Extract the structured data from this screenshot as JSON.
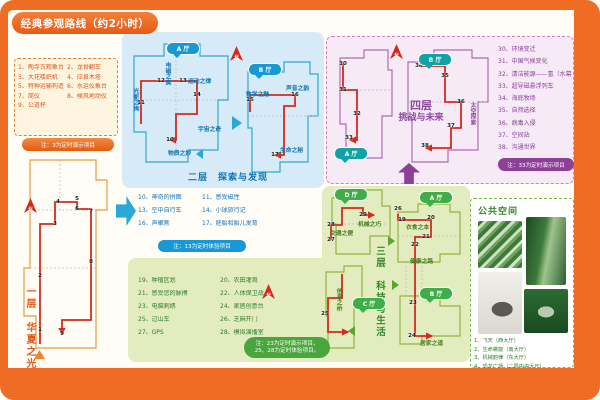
{
  "title": "经典参观路线（约2小时）",
  "compass_label": "北",
  "floor1": {
    "title": "一层　华夏之光",
    "items": [
      [
        "1、",
        "陶寺古观象台"
      ],
      [
        "2、",
        "龙骨翻车"
      ],
      [
        "3、",
        "大花楼织机"
      ],
      [
        "4、",
        "应县木塔"
      ],
      [
        "5、",
        "特种运输构造"
      ],
      [
        "6、",
        "水运仪象台"
      ],
      [
        "7、",
        "简仪"
      ],
      [
        "8、",
        "候风地动仪"
      ],
      [
        "9、",
        "公道杯"
      ]
    ],
    "note": "注：3为定时演示项目"
  },
  "floor2": {
    "title": "二层　探索与发现",
    "items": [
      [
        "10、",
        "神奇的拼图"
      ],
      [
        "11、",
        "感受磁性"
      ],
      [
        "13、",
        "空中自行车"
      ],
      [
        "14、",
        "小球旅行记"
      ],
      [
        "16、",
        "声聚焦"
      ],
      [
        "17、",
        "胚胎和胎儿发育"
      ]
    ],
    "note": "注：13为定时体验项目"
  },
  "floor3": {
    "title": "三层　科技与生活",
    "items": [
      [
        "19、",
        "种植区划"
      ],
      [
        "20、",
        "农田灌溉"
      ],
      [
        "21、",
        "感受您的脉搏"
      ],
      [
        "22、",
        "人体保卫战"
      ],
      [
        "23、",
        "电脑刺绣"
      ],
      [
        "24、",
        "家居创意台"
      ],
      [
        "25、",
        "过山车"
      ],
      [
        "26、",
        "芝麻开门"
      ],
      [
        "27、",
        "GPS"
      ],
      [
        "28、",
        "模拟演播室"
      ]
    ],
    "note": "注：23为定时演示项目，\n25、28为定时体验项目。"
  },
  "floor4": {
    "title_line1": "四层",
    "title_line2": "挑战与未来",
    "items": [
      [
        "30、",
        "环境变迁"
      ],
      [
        "31、",
        "中国气候变化"
      ],
      [
        "32、",
        "清洁能源——氢（水幕）"
      ],
      [
        "33、",
        "超导磁悬浮列车"
      ],
      [
        "34、",
        "海底牧场"
      ],
      [
        "35、",
        "自然选择"
      ],
      [
        "36、",
        "病毒入侵"
      ],
      [
        "37、",
        "空间站"
      ],
      [
        "38、",
        "沟通世界"
      ]
    ],
    "note": "注：33为定时演示项目"
  },
  "public_space": {
    "title": "公共空间",
    "captions": [
      "1、飞天（西大厅）",
      "2、生命螺旋（南大厅）",
      "3、机械韵律（东大厅）",
      "4、恐龙广场（二层中央大厅）"
    ],
    "photos": [
      "ceiling-art",
      "spiral-staircase",
      "dinosaur-skeleton",
      "relief-mural"
    ]
  },
  "hall_labels": [
    {
      "t": "光影之绚",
      "x": 131,
      "y": 88,
      "v": 1,
      "c": "f2"
    },
    {
      "t": "电磁之奥",
      "x": 163,
      "y": 62,
      "v": 1,
      "c": "f2"
    },
    {
      "t": "运动之律",
      "x": 188,
      "y": 76,
      "v": 0,
      "c": "f2"
    },
    {
      "t": "宇宙之奇",
      "x": 198,
      "y": 124,
      "v": 0,
      "c": "f2"
    },
    {
      "t": "物质之妙",
      "x": 168,
      "y": 148,
      "v": 0,
      "c": "f2"
    },
    {
      "t": "数学之魅",
      "x": 246,
      "y": 89,
      "v": 0,
      "c": "f2"
    },
    {
      "t": "声音之韵",
      "x": 286,
      "y": 83,
      "v": 0,
      "c": "f2"
    },
    {
      "t": "生命之秘",
      "x": 280,
      "y": 145,
      "v": 0,
      "c": "f2"
    },
    {
      "t": "机械之巧",
      "x": 358,
      "y": 219,
      "v": 0,
      "c": "f3"
    },
    {
      "t": "交通之便",
      "x": 330,
      "y": 228,
      "v": 0,
      "c": "f3"
    },
    {
      "t": "衣食之本",
      "x": 406,
      "y": 222,
      "v": 0,
      "c": "f3"
    },
    {
      "t": "健康之路",
      "x": 410,
      "y": 256,
      "v": 0,
      "c": "f3"
    },
    {
      "t": "信息之桥",
      "x": 334,
      "y": 288,
      "v": 1,
      "c": "f3"
    },
    {
      "t": "居家之道",
      "x": 420,
      "y": 338,
      "v": 0,
      "c": "f3"
    },
    {
      "t": "太空探索",
      "x": 468,
      "y": 102,
      "v": 1,
      "c": "f4"
    }
  ],
  "hall_pills": [
    {
      "t": "A 厅",
      "x": 166,
      "y": 42,
      "c": "f2"
    },
    {
      "t": "B 厅",
      "x": 248,
      "y": 63,
      "c": "f2"
    },
    {
      "t": "D 厅",
      "x": 334,
      "y": 188,
      "c": "f3"
    },
    {
      "t": "A 厅",
      "x": 419,
      "y": 191,
      "c": "f3"
    },
    {
      "t": "C 厅",
      "x": 352,
      "y": 297,
      "c": "f3"
    },
    {
      "t": "B 厅",
      "x": 419,
      "y": 287,
      "c": "f3"
    },
    {
      "t": "A 厅",
      "x": 334,
      "y": 147,
      "c": "f4"
    },
    {
      "t": "B 厅",
      "x": 418,
      "y": 53,
      "c": "f4"
    }
  ],
  "stops": [
    {
      "n": "1",
      "x": 40,
      "y": 330
    },
    {
      "n": "2",
      "x": 40,
      "y": 276
    },
    {
      "n": "3",
      "x": 55,
      "y": 224
    },
    {
      "n": "4",
      "x": 58,
      "y": 202
    },
    {
      "n": "5",
      "x": 77,
      "y": 199
    },
    {
      "n": "6",
      "x": 77,
      "y": 209
    },
    {
      "n": "7",
      "x": 91,
      "y": 212
    },
    {
      "n": "8",
      "x": 91,
      "y": 262
    },
    {
      "n": "9",
      "x": 62,
      "y": 334
    },
    {
      "n": "10",
      "x": 170,
      "y": 140
    },
    {
      "n": "11",
      "x": 141,
      "y": 103
    },
    {
      "n": "12",
      "x": 161,
      "y": 81
    },
    {
      "n": "13",
      "x": 183,
      "y": 81
    },
    {
      "n": "14",
      "x": 197,
      "y": 95
    },
    {
      "n": "15",
      "x": 250,
      "y": 100
    },
    {
      "n": "16",
      "x": 295,
      "y": 95
    },
    {
      "n": "17",
      "x": 275,
      "y": 155
    },
    {
      "n": "19",
      "x": 402,
      "y": 220
    },
    {
      "n": "20",
      "x": 431,
      "y": 218
    },
    {
      "n": "21",
      "x": 426,
      "y": 237
    },
    {
      "n": "22",
      "x": 415,
      "y": 245
    },
    {
      "n": "23",
      "x": 413,
      "y": 303
    },
    {
      "n": "24",
      "x": 412,
      "y": 336
    },
    {
      "n": "25",
      "x": 325,
      "y": 314
    },
    {
      "n": "26",
      "x": 398,
      "y": 209
    },
    {
      "n": "27",
      "x": 331,
      "y": 240
    },
    {
      "n": "28",
      "x": 331,
      "y": 225
    },
    {
      "n": "29",
      "x": 363,
      "y": 215
    },
    {
      "n": "30",
      "x": 343,
      "y": 64
    },
    {
      "n": "31",
      "x": 343,
      "y": 90
    },
    {
      "n": "32",
      "x": 357,
      "y": 114
    },
    {
      "n": "33",
      "x": 349,
      "y": 138
    },
    {
      "n": "34",
      "x": 419,
      "y": 66
    },
    {
      "n": "35",
      "x": 445,
      "y": 76
    },
    {
      "n": "36",
      "x": 461,
      "y": 102
    },
    {
      "n": "37",
      "x": 451,
      "y": 126
    },
    {
      "n": "38",
      "x": 425,
      "y": 146
    }
  ],
  "colors": {
    "frame_orange": "#ee6c23",
    "route_red": "#d42a1d",
    "floor1_orange": "#e2571b",
    "floor2_blue": "#1173b5",
    "floor3_green": "#35872c",
    "floor4_purple": "#8c4a9e",
    "pill_teal": "#0fa3a5"
  }
}
